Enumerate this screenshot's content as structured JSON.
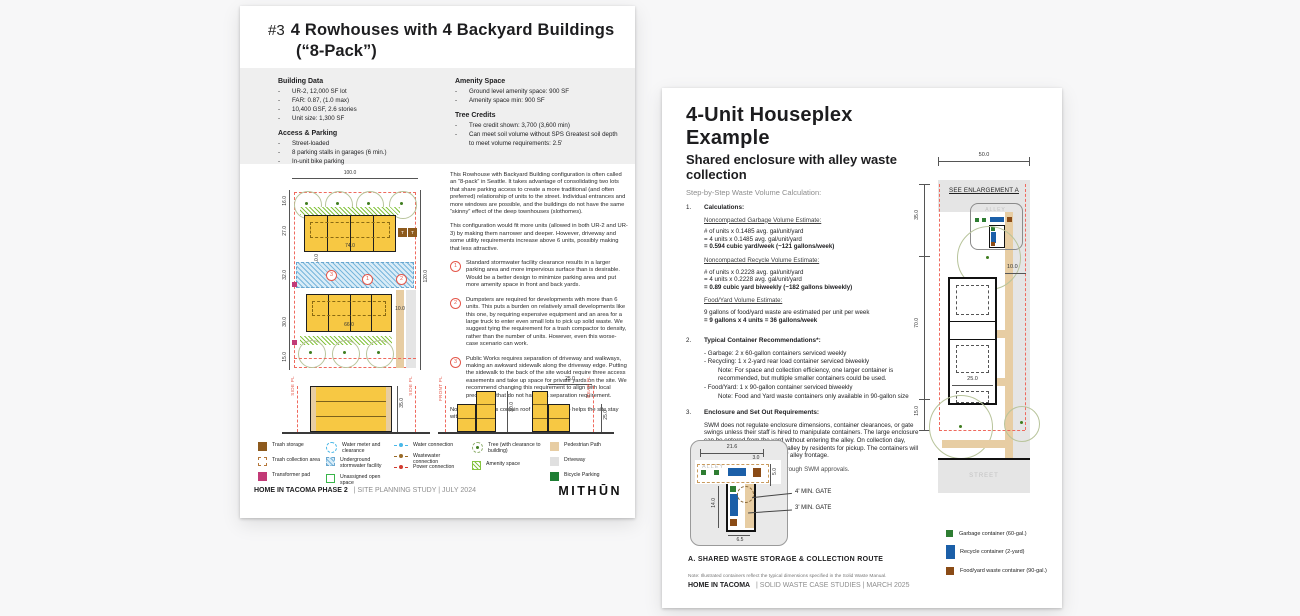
{
  "page1": {
    "header": {
      "num": "#3",
      "title": "4 Rowhouses with 4 Backyard Buildings",
      "title2": "(“8-Pack”)"
    },
    "info": {
      "building_heading": "Building Data",
      "building": [
        "UR-2, 12,000 SF lot",
        "FAR: 0.87, (1.0 max)",
        "10,400 GSF, 2.6 stories",
        "Unit size: 1,300 SF"
      ],
      "access_heading": "Access & Parking",
      "access": [
        "Street-loaded",
        "8 parking stalls in garages (6 min.)",
        "In-unit bike parking"
      ],
      "amenity_heading": "Amenity Space",
      "amenity": [
        "Ground level amenity space: 900 SF",
        "Amenity space min: 900 SF"
      ],
      "tree_heading": "Tree Credits",
      "tree": [
        "Tree credit shown: 3,700 (3,600 min)",
        "Can meet soil volume without SPS Greatest soil depth to meet volume requirements: 2.5'"
      ]
    },
    "plan": {
      "dim_top": "100.0",
      "dim_right": "120.0",
      "dims_left": [
        "16.0",
        "27.0",
        "32.0",
        "30.0",
        "15.0"
      ],
      "bldg1": "74.0",
      "bldg2": "66.0",
      "dim_path": "10.0",
      "dim_inner": "10.0",
      "trash": "T",
      "m1": "1",
      "m2": "2",
      "m3": "3"
    },
    "notes": {
      "p1": "This Rowhouse with Backyard Building configuration is often called an “8-pack” in Seattle. It takes advantage of consolidating two lots that share parking access to create a more traditional (and often preferred) relationship of units to the street. Individual entrances and more windows are possible, and the buildings do not have the same “skinny” effect of the deep townhouses (slothomes).",
      "p2": "This configuration would fit more units (allowed in both UR-2 and UR-3) by making them narrower and deeper. However, driveway and some utility requirements increase above 6 units, possibly making that less attractive.",
      "items": [
        {
          "n": "1",
          "text": "Standard stormwater facility clearance results in a larger parking area and more impervious surface than is desirable. Would be a better design to minimize parking area and put more amenity space in front and back yards."
        },
        {
          "n": "2",
          "text": "Dumpsters are required for developments with more than 6 units. This puts a burden on relatively small developments like this one, by requiring expensive equipment and an area for a large truck to enter even small lots to pick up solid waste. We suggest tying the requirement for a trash compactor to density, rather than the number of units. However, even this worse-case scenario can work."
        },
        {
          "n": "3",
          "text": "Public Works requires separation of driveway and walkways, making an awkward sidewalk along the driveway edge. Putting the sidewalk to the back of the site would require three access easements and take up space for private yards on the site. We recommend changing this requirement to align with local precedents that do not have this separation requirement."
        }
      ],
      "closing": "Note the 3rd levels contain roof decks that also helps the site stay within FAR limits."
    },
    "elev": {
      "side_pl_left": "SIDE PL",
      "side_pl_right": "SIDE PL",
      "front_pl": "FRONT PL",
      "rear_pl": "REAR PL",
      "h1": "35.0",
      "h2": "30.0",
      "h3": "25.0",
      "w3": "25.0"
    },
    "legend": {
      "trash_storage": "Trash storage",
      "trash_collection": "Trash collection area",
      "transformer": "Transformer pad",
      "water_meter": "Water meter and clearance",
      "stormwater": "Underground stormwater facility",
      "open_space": "Unassigned open space",
      "water_conn": "Water connection",
      "wastewater_conn": "Wastewater connection",
      "power_conn": "Power connection",
      "tree": "Tree (with clearance to building)",
      "amenity": "Amenity space",
      "ped_path": "Pedestrian Path",
      "driveway": "Driveway",
      "bike": "Bicycle Parking"
    },
    "footer": {
      "bold": "HOME IN TACOMA PHASE 2",
      "rest": "|  SITE PLANNING STUDY |  JULY 2024",
      "logo": "MITHŪN"
    }
  },
  "page2": {
    "title": "4-Unit Houseplex Example",
    "subtitle": "Shared enclosure with alley waste collection",
    "intro": "Step-by-Step Waste Volume Calculation:",
    "s1": {
      "num": "1.",
      "heading": "Calculations:",
      "blocks": [
        {
          "h": "Noncompacted Garbage Volume Estimate:",
          "l1": "# of units x 0.1485 avg. gal/unit/yard",
          "l2": "= 4 units x 0.1485 avg. gal/unit/yard",
          "bold": "= 0.594 cubic yard/week (~121 gallons/week)"
        },
        {
          "h": "Noncompacted Recycle Volume Estimate:",
          "l1": "# of units x 0.2228 avg. gal/unit/yard",
          "l2": "= 4 units x 0.2228 avg. gal/unit/yard",
          "bold": "= 0.89 cubic yard biweekly (~182 gallons biweekly)"
        },
        {
          "h": "Food/Yard Volume Estimate:",
          "l1": "9 gallons of food/yard waste are estimated per unit per week",
          "l2": "",
          "bold": "= 9 gallons x 4 units = 36 gallons/week"
        }
      ]
    },
    "s2": {
      "num": "2.",
      "heading": "Typical Container Recommendations*:",
      "bullets": [
        {
          "text": "- Garbage: 2 x 60-gallon containers serviced weekly",
          "note": ""
        },
        {
          "text": "- Recycling: 1 x 2-yard rear load container serviced biweekly",
          "note": "Note: For space and collection efficiency, one larger container is recommended, but multiple smaller containers could be used."
        },
        {
          "text": "- Food/Yard: 1 x 90-gallon container serviced biweekly",
          "note": "Note: Food and Yard waste containers only available in 90-gallon size"
        }
      ]
    },
    "s3": {
      "num": "3.",
      "heading": "Enclosure and Set Out Requirements:",
      "body": "SWM does not regulate enclosure dimensions, container clearances, or gate swings unless their staff is hired to manipulate containers. The large enclosure can be entered from the yard without entering the alley. On collection day, containers will be rolled to the alley by residents for pickup. The containers will occupy 21.6 feet (21'-7 1/2\") of alley frontage.",
      "footnote": "*Final container determined through SWM approvals."
    },
    "plan": {
      "dim_top": "50.0",
      "see": "SEE ENLARGEMENT A",
      "alley": "ALLEY",
      "street": "STREET",
      "dims_left": [
        "35.0",
        "70.0",
        "15.0"
      ],
      "dim_10": "10.0",
      "dim_25": "25.0"
    },
    "inset": {
      "d216": "21.6",
      "d30": "3.0",
      "d50": "5.0",
      "d140": "14.0",
      "d65": "6.5",
      "alley": "ALLEY",
      "gate4": "4' MIN. GATE",
      "gate3": "3' MIN. GATE",
      "caption": "A. SHARED WASTE STORAGE & COLLECTION ROUTE"
    },
    "legend": [
      {
        "label": "Garbage container (60-gal.)"
      },
      {
        "label": "Recycle container (2-yard)"
      },
      {
        "label": "Food/yard waste container (90-gal.)"
      }
    ],
    "footer": {
      "note": "Note: Illustrated containers reflect the typical dimensions specified in the Solid Waste Manual.",
      "bold": "HOME IN TACOMA",
      "rest": "|  SOLID WASTE CASE STUDIES  |  MARCH 2025"
    }
  }
}
